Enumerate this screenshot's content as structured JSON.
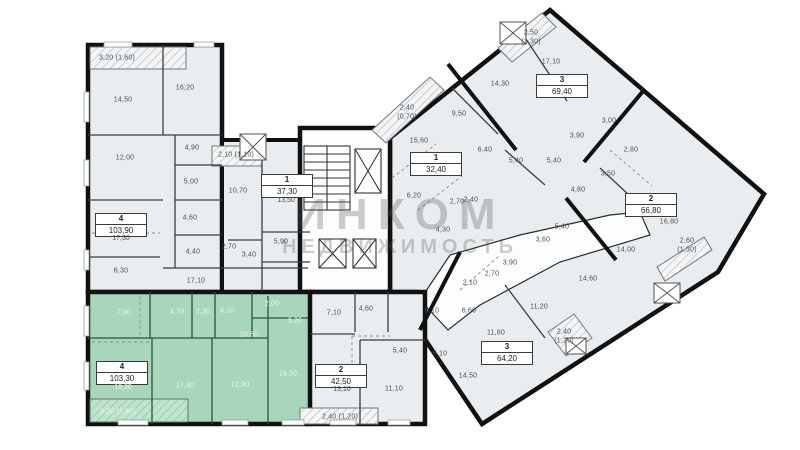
{
  "watermark": {
    "line1": "ИНКОМ",
    "line2": "НЕДВИЖИМОСТЬ"
  },
  "colors": {
    "highlight": "#a9d6ba",
    "room_fill": "#e9edf0",
    "wall": "#111111",
    "balcony_hatch": "#b8c0c6"
  },
  "apartments": [
    {
      "id": "apt-4-left",
      "rooms": "4",
      "total_area": "103,90",
      "living_area": "17,30"
    },
    {
      "id": "apt-1-mid",
      "rooms": "1",
      "total_area": "37,30",
      "living_area": "13,50"
    },
    {
      "id": "apt-1-wing",
      "rooms": "1",
      "total_area": "32,40"
    },
    {
      "id": "apt-3-top",
      "rooms": "3",
      "total_area": "69,40"
    },
    {
      "id": "apt-2-right",
      "rooms": "2",
      "total_area": "66,80"
    },
    {
      "id": "apt-3-low",
      "rooms": "3",
      "total_area": "64,20"
    },
    {
      "id": "apt-2-bot",
      "rooms": "2",
      "total_area": "42,50",
      "living_area": "13,10"
    },
    {
      "id": "apt-4-green",
      "rooms": "4",
      "total_area": "103,30",
      "living_area": "18,30",
      "highlighted": true
    }
  ],
  "room_labels": [
    {
      "text": "3,20 (1,60)",
      "x": 117,
      "y": 58
    },
    {
      "text": "14,50",
      "x": 123,
      "y": 100
    },
    {
      "text": "16,20",
      "x": 185,
      "y": 88
    },
    {
      "text": "12,00",
      "x": 125,
      "y": 158
    },
    {
      "text": "4,90",
      "x": 192,
      "y": 148
    },
    {
      "text": "5,00",
      "x": 191,
      "y": 182
    },
    {
      "text": "4,60",
      "x": 190,
      "y": 218
    },
    {
      "text": "4,40",
      "x": 193,
      "y": 252
    },
    {
      "text": "6,30",
      "x": 121,
      "y": 271
    },
    {
      "text": "17,10",
      "x": 196,
      "y": 281
    },
    {
      "text": "2,10 (1,10)",
      "x": 236,
      "y": 155
    },
    {
      "text": "10,70",
      "x": 238,
      "y": 191
    },
    {
      "text": "5,90",
      "x": 281,
      "y": 242
    },
    {
      "text": "2,70",
      "x": 229,
      "y": 247
    },
    {
      "text": "3,40",
      "x": 249,
      "y": 255
    },
    {
      "text": "2,40",
      "x": 407,
      "y": 108
    },
    {
      "text": "(0,70)",
      "x": 407,
      "y": 117
    },
    {
      "text": "15,60",
      "x": 419,
      "y": 141
    },
    {
      "text": "6,20",
      "x": 414,
      "y": 196
    },
    {
      "text": "2,70",
      "x": 457,
      "y": 202
    },
    {
      "text": "2,40",
      "x": 471,
      "y": 200
    },
    {
      "text": "4,30",
      "x": 443,
      "y": 230
    },
    {
      "text": "2,50",
      "x": 531,
      "y": 33
    },
    {
      "text": "(1,30)",
      "x": 531,
      "y": 42
    },
    {
      "text": "17,10",
      "x": 551,
      "y": 62
    },
    {
      "text": "14,30",
      "x": 500,
      "y": 84
    },
    {
      "text": "9,50",
      "x": 459,
      "y": 114
    },
    {
      "text": "6,40",
      "x": 485,
      "y": 150
    },
    {
      "text": "3,00",
      "x": 609,
      "y": 121
    },
    {
      "text": "3,90",
      "x": 577,
      "y": 136
    },
    {
      "text": "5,40",
      "x": 516,
      "y": 161
    },
    {
      "text": "5,40",
      "x": 554,
      "y": 161
    },
    {
      "text": "3,50",
      "x": 608,
      "y": 174
    },
    {
      "text": "4,80",
      "x": 578,
      "y": 190
    },
    {
      "text": "2,80",
      "x": 631,
      "y": 150
    },
    {
      "text": "5,40",
      "x": 562,
      "y": 227
    },
    {
      "text": "16,80",
      "x": 669,
      "y": 222
    },
    {
      "text": "14,00",
      "x": 626,
      "y": 250
    },
    {
      "text": "2,60",
      "x": 687,
      "y": 241
    },
    {
      "text": "(1,30)",
      "x": 687,
      "y": 250
    },
    {
      "text": "3,60",
      "x": 543,
      "y": 240
    },
    {
      "text": "3,90",
      "x": 510,
      "y": 263
    },
    {
      "text": "2,70",
      "x": 492,
      "y": 274
    },
    {
      "text": "2,10",
      "x": 470,
      "y": 283
    },
    {
      "text": "14,60",
      "x": 588,
      "y": 279
    },
    {
      "text": "11,20",
      "x": 539,
      "y": 307
    },
    {
      "text": "6,60",
      "x": 469,
      "y": 311
    },
    {
      "text": "5,10",
      "x": 432,
      "y": 311
    },
    {
      "text": "11,80",
      "x": 496,
      "y": 333
    },
    {
      "text": "2,40",
      "x": 564,
      "y": 332
    },
    {
      "text": "(1,20)",
      "x": 564,
      "y": 341
    },
    {
      "text": "5,10",
      "x": 440,
      "y": 354
    },
    {
      "text": "14,50",
      "x": 468,
      "y": 376
    },
    {
      "text": "7,10",
      "x": 334,
      "y": 313
    },
    {
      "text": "4,60",
      "x": 366,
      "y": 309
    },
    {
      "text": "5,40",
      "x": 400,
      "y": 351
    },
    {
      "text": "11,10",
      "x": 394,
      "y": 389
    },
    {
      "text": "2,40 (1,20)",
      "x": 340,
      "y": 417
    },
    {
      "text": "7,90",
      "x": 124,
      "y": 313,
      "cls": "og"
    },
    {
      "text": "4,70",
      "x": 177,
      "y": 312,
      "cls": "og"
    },
    {
      "text": "2,30",
      "x": 203,
      "y": 312,
      "cls": "og"
    },
    {
      "text": "3,10",
      "x": 227,
      "y": 311,
      "cls": "og"
    },
    {
      "text": "2,00",
      "x": 272,
      "y": 304,
      "cls": "og"
    },
    {
      "text": "3,20",
      "x": 295,
      "y": 321,
      "cls": "og"
    },
    {
      "text": "10,50",
      "x": 249,
      "y": 335,
      "cls": "og"
    },
    {
      "text": "17,30",
      "x": 185,
      "y": 386,
      "cls": "og"
    },
    {
      "text": "12,90",
      "x": 240,
      "y": 385,
      "cls": "og"
    },
    {
      "text": "19,50",
      "x": 288,
      "y": 374,
      "cls": "og"
    },
    {
      "text": "3,20 (1,60)",
      "x": 118,
      "y": 412,
      "cls": "og"
    }
  ]
}
